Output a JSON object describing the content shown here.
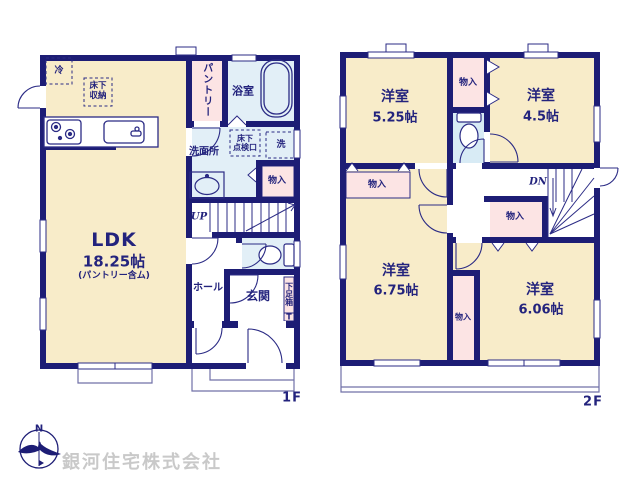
{
  "branding": {
    "company_name": "銀河住宅株式会社",
    "compass_north": "N"
  },
  "floor1": {
    "floor_label": "1F",
    "ldk_name": "LDK",
    "ldk_size": "18.25帖",
    "ldk_note": "(パントリー含ム)",
    "fridge": "冷",
    "underfloor_storage_line1": "床下",
    "underfloor_storage_line2": "収納",
    "pantry": "パントリー",
    "bathroom": "浴室",
    "washroom": "洗面所",
    "hatch_line1": "床下",
    "hatch_line2": "点検口",
    "laundry": "洗",
    "closet": "物入",
    "stairs_up": "UP",
    "hall": "ホール",
    "entrance": "玄関",
    "shoe_box": "下足箱",
    "shoe_box_t": "T"
  },
  "floor2": {
    "floor_label": "2F",
    "room1_name": "洋室",
    "room1_size": "5.25帖",
    "room2_name": "洋室",
    "room2_size": "4.5帖",
    "room3_name": "洋室",
    "room3_size": "6.75帖",
    "room4_name": "洋室",
    "room4_size": "6.06帖",
    "closet_top": "物入",
    "closet_left": "物入",
    "closet_mid": "物入",
    "closet_side": "物入",
    "stairs_down": "DN"
  },
  "colors": {
    "wall_navy": "#1d1d75",
    "line_navy": "#2b2b85",
    "room_floor_cream": "#f8ecc9",
    "closet_pink": "#fce4e4",
    "wet_area_blue": "#e2eff7",
    "text_navy": "#23237d",
    "watermark_gray": "#c9c9c9"
  }
}
